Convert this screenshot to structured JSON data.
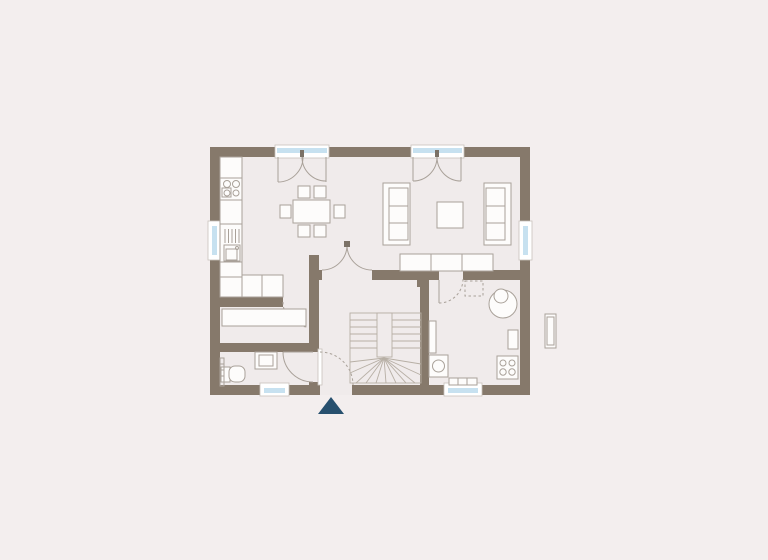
{
  "colors": {
    "background": "#f3eeee",
    "floor": "#f0ebeb",
    "wall": "#86796b",
    "furniture_fill": "#fdfcfb",
    "furniture_stroke": "#a9a199",
    "window_glass": "#c7e1f0",
    "window_frame": "#ffffff",
    "frame_stroke": "#c9c2bb",
    "stair_line": "#b7afa5",
    "door_arc": "#a9a199",
    "tick": "#7b7166",
    "entrance_marker": "#27506e"
  },
  "icons": {
    "entrance_marker": "triangle-up"
  }
}
